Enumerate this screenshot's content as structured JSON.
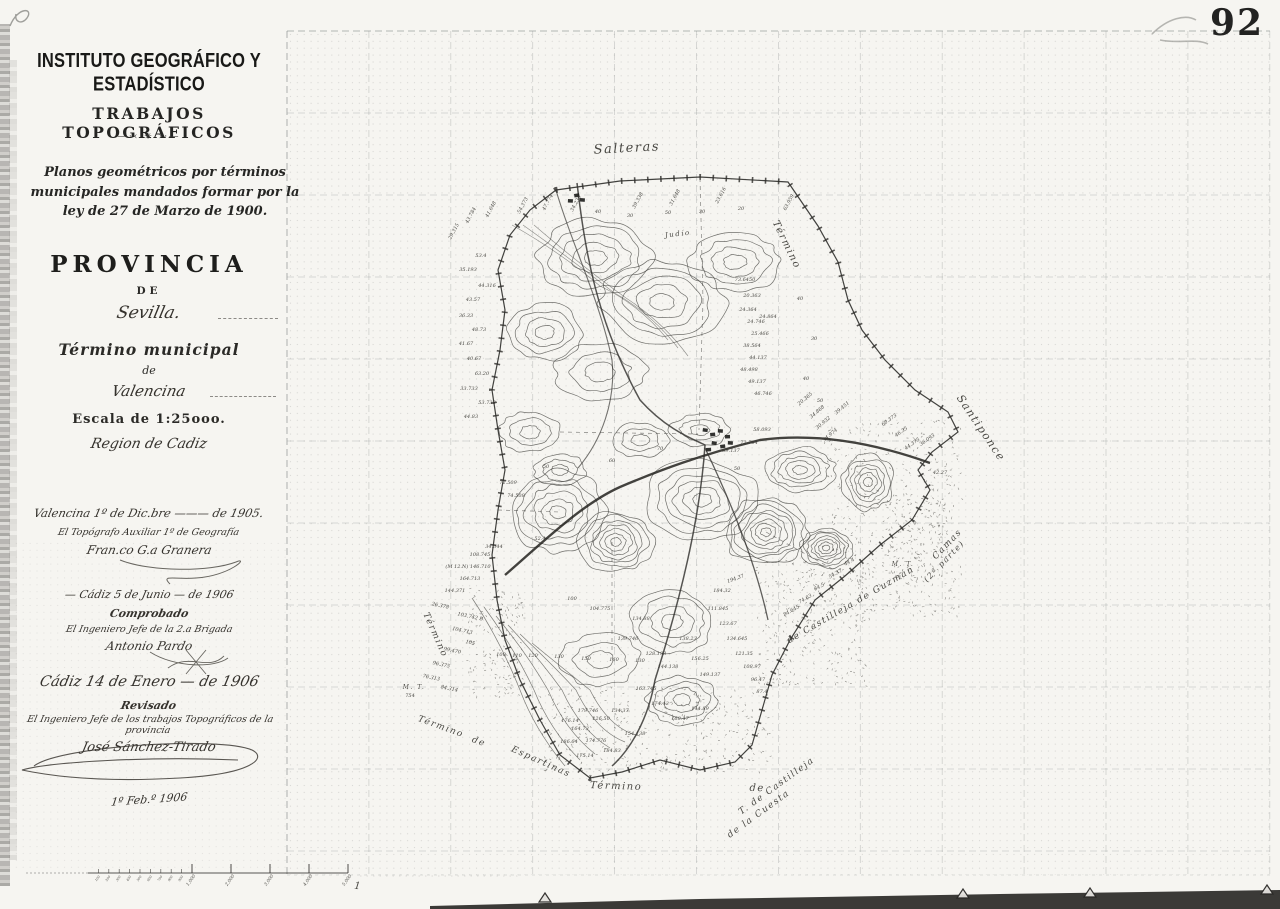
{
  "page": {
    "corner_number": "92",
    "date_note": "1º Feb.º 1906"
  },
  "title_block": {
    "institution": "INSTITUTO GEOGRÁFICO Y ESTADÍSTICO",
    "department": "TRABAJOS TOPOGRÁFICOS",
    "ornament": "―·‹  ✳  ›·―",
    "law_note": "Planos geométricos por términos municipales mandados formar por la ley de 27 de Marzo de 1900.",
    "province_label": "PROVINCIA",
    "de1": "DE",
    "province": "Sevilla.",
    "municipality_label": "Término municipal",
    "de2": "de",
    "municipality": "Valencina",
    "scale": "Escala de 1:25ooo.",
    "region": "Region de Cadiz"
  },
  "certifications": [
    {
      "place_date": "Valencina 1º de Dic.bre ——— de 1905.",
      "role": "El Topógrafo Auxiliar 1º de Geografía",
      "signature": "Fran.co G.a Granera"
    },
    {
      "place_date": "— Cádiz 5 de Junio — de 1906",
      "status": "Comprobado",
      "role": "El Ingeniero Jefe de la 2.a Brigada",
      "signature": "Antonio Pardo"
    },
    {
      "place_date": "Cádiz  14 de Enero — de 1906",
      "status": "Revisado",
      "role": "El Ingeniero Jefe de los trabajos Topográficos de la provincia",
      "signature": "José Sánchez-Tirado"
    }
  ],
  "map": {
    "place_labels": [
      {
        "t": "Salteras",
        "x": 627,
        "y": 152,
        "r": -3,
        "s": 13
      },
      {
        "t": "Término",
        "x": 784,
        "y": 246,
        "r": 64,
        "s": 10
      },
      {
        "t": "Santiponce",
        "x": 978,
        "y": 430,
        "r": 56,
        "s": 11
      },
      {
        "t": "Camas",
        "x": 949,
        "y": 546,
        "r": -46,
        "s": 9
      },
      {
        "t": "(2ª parte)",
        "x": 946,
        "y": 563,
        "r": -46,
        "s": 8
      },
      {
        "t": "de Castilleja de Guzmán",
        "x": 852,
        "y": 607,
        "r": -30,
        "s": 9
      },
      {
        "t": "T. de Castilleja",
        "x": 778,
        "y": 788,
        "r": -36,
        "s": 9
      },
      {
        "t": "de la Cuesta",
        "x": 760,
        "y": 816,
        "r": -36,
        "s": 9
      },
      {
        "t": "Término",
        "x": 433,
        "y": 636,
        "r": 66,
        "s": 9
      },
      {
        "t": "Término",
        "x": 440,
        "y": 729,
        "r": 20,
        "s": 9
      },
      {
        "t": "de",
        "x": 478,
        "y": 744,
        "r": 20,
        "s": 9
      },
      {
        "t": "Espartinas",
        "x": 540,
        "y": 764,
        "r": 24,
        "s": 9
      },
      {
        "t": "Término",
        "x": 616,
        "y": 789,
        "r": 2,
        "s": 10
      },
      {
        "t": "de",
        "x": 757,
        "y": 791,
        "r": 2,
        "s": 10
      },
      {
        "t": "Judío",
        "x": 678,
        "y": 236,
        "r": -6,
        "s": 7
      },
      {
        "t": "M. T.",
        "x": 903,
        "y": 566,
        "r": 0,
        "s": 6
      },
      {
        "t": "M. T.",
        "x": 414,
        "y": 689,
        "r": 0,
        "s": 6
      }
    ],
    "spot_heights": [
      {
        "t": "43.784",
        "x": 472,
        "y": 216,
        "r": -62
      },
      {
        "t": "41.648",
        "x": 492,
        "y": 210,
        "r": -62
      },
      {
        "t": "54.373",
        "x": 524,
        "y": 206,
        "r": -62
      },
      {
        "t": "47.774",
        "x": 549,
        "y": 203,
        "r": -62
      },
      {
        "t": "34.236",
        "x": 577,
        "y": 204,
        "r": -62
      },
      {
        "t": "39.338",
        "x": 639,
        "y": 201,
        "r": -62
      },
      {
        "t": "31.648",
        "x": 676,
        "y": 198,
        "r": -62
      },
      {
        "t": "23.616",
        "x": 722,
        "y": 196,
        "r": -62
      },
      {
        "t": "63.959",
        "x": 790,
        "y": 203,
        "r": -62
      },
      {
        "t": "29.315",
        "x": 455,
        "y": 232,
        "r": -62
      },
      {
        "t": "40",
        "x": 598,
        "y": 213,
        "r": 0
      },
      {
        "t": "30",
        "x": 630,
        "y": 217,
        "r": 0
      },
      {
        "t": "50",
        "x": 668,
        "y": 214,
        "r": 0
      },
      {
        "t": "30",
        "x": 702,
        "y": 213,
        "r": 0
      },
      {
        "t": "20",
        "x": 741,
        "y": 210,
        "r": 0
      },
      {
        "t": "53.4",
        "x": 481,
        "y": 257,
        "r": 0
      },
      {
        "t": "35.193",
        "x": 468,
        "y": 271,
        "r": 0
      },
      {
        "t": "44.316",
        "x": 487,
        "y": 287,
        "r": 0
      },
      {
        "t": "43.57",
        "x": 473,
        "y": 301,
        "r": 0
      },
      {
        "t": "36.33",
        "x": 466,
        "y": 317,
        "r": 0
      },
      {
        "t": "48.73",
        "x": 479,
        "y": 331,
        "r": 0
      },
      {
        "t": "41.67",
        "x": 466,
        "y": 345,
        "r": 0
      },
      {
        "t": "40.67",
        "x": 474,
        "y": 360,
        "r": 0
      },
      {
        "t": "63.20",
        "x": 482,
        "y": 375,
        "r": 0
      },
      {
        "t": "33.733",
        "x": 469,
        "y": 390,
        "r": 0
      },
      {
        "t": "53.733",
        "x": 487,
        "y": 404,
        "r": 0
      },
      {
        "t": "44.83",
        "x": 471,
        "y": 418,
        "r": 0
      },
      {
        "t": "72.509",
        "x": 508,
        "y": 484,
        "r": 0
      },
      {
        "t": "74.508",
        "x": 516,
        "y": 497,
        "r": 0
      },
      {
        "t": "52.4",
        "x": 540,
        "y": 540,
        "r": 0
      },
      {
        "t": "34.344",
        "x": 494,
        "y": 548,
        "r": 0
      },
      {
        "t": "108.745",
        "x": 480,
        "y": 556,
        "r": 0
      },
      {
        "t": "(M 12.N) 146.710",
        "x": 468,
        "y": 568,
        "r": 0
      },
      {
        "t": "164.713",
        "x": 470,
        "y": 580,
        "r": 0
      },
      {
        "t": "144.371",
        "x": 455,
        "y": 592,
        "r": 0
      },
      {
        "t": "73.6450",
        "x": 745,
        "y": 281,
        "r": 0
      },
      {
        "t": "20.363",
        "x": 752,
        "y": 297,
        "r": 0
      },
      {
        "t": "24.364",
        "x": 748,
        "y": 311,
        "r": 0
      },
      {
        "t": "24.746",
        "x": 756,
        "y": 323,
        "r": 0
      },
      {
        "t": "24.864",
        "x": 768,
        "y": 318,
        "r": 0
      },
      {
        "t": "25.466",
        "x": 760,
        "y": 335,
        "r": 0
      },
      {
        "t": "38.564",
        "x": 752,
        "y": 347,
        "r": 0
      },
      {
        "t": "44.137",
        "x": 758,
        "y": 359,
        "r": 0
      },
      {
        "t": "48.498",
        "x": 749,
        "y": 371,
        "r": 0
      },
      {
        "t": "49.137",
        "x": 757,
        "y": 383,
        "r": 0
      },
      {
        "t": "46.746",
        "x": 763,
        "y": 395,
        "r": 0
      },
      {
        "t": "40",
        "x": 800,
        "y": 300,
        "r": 0
      },
      {
        "t": "30",
        "x": 814,
        "y": 340,
        "r": 0
      },
      {
        "t": "40",
        "x": 806,
        "y": 380,
        "r": 0
      },
      {
        "t": "50",
        "x": 820,
        "y": 402,
        "r": 0
      },
      {
        "t": "20.365",
        "x": 806,
        "y": 400,
        "r": -40
      },
      {
        "t": "34.868",
        "x": 818,
        "y": 413,
        "r": -40
      },
      {
        "t": "30.932",
        "x": 824,
        "y": 424,
        "r": -40
      },
      {
        "t": "34.974",
        "x": 831,
        "y": 436,
        "r": -40
      },
      {
        "t": "39.451",
        "x": 843,
        "y": 409,
        "r": -40
      },
      {
        "t": "60.373",
        "x": 890,
        "y": 421,
        "r": -35
      },
      {
        "t": "46.35",
        "x": 902,
        "y": 433,
        "r": -35
      },
      {
        "t": "44.375",
        "x": 913,
        "y": 445,
        "r": -35
      },
      {
        "t": "36.093",
        "x": 928,
        "y": 441,
        "r": -35
      },
      {
        "t": "42.27",
        "x": 940,
        "y": 474,
        "r": 0
      },
      {
        "t": "69.137",
        "x": 731,
        "y": 452,
        "r": 0
      },
      {
        "t": "72.764",
        "x": 749,
        "y": 444,
        "r": 0
      },
      {
        "t": "58.093",
        "x": 762,
        "y": 431,
        "r": 0
      },
      {
        "t": "70",
        "x": 660,
        "y": 450,
        "r": 0
      },
      {
        "t": "60",
        "x": 612,
        "y": 462,
        "r": 0
      },
      {
        "t": "50",
        "x": 546,
        "y": 468,
        "r": 0
      },
      {
        "t": "50",
        "x": 737,
        "y": 470,
        "r": 0
      },
      {
        "t": "100",
        "x": 572,
        "y": 600,
        "r": 0
      },
      {
        "t": "100",
        "x": 501,
        "y": 656,
        "r": 0
      },
      {
        "t": "110",
        "x": 517,
        "y": 657,
        "r": 0
      },
      {
        "t": "120",
        "x": 533,
        "y": 657,
        "r": 0
      },
      {
        "t": "130",
        "x": 559,
        "y": 658,
        "r": 0
      },
      {
        "t": "150",
        "x": 586,
        "y": 660,
        "r": 0
      },
      {
        "t": "160",
        "x": 614,
        "y": 661,
        "r": 0
      },
      {
        "t": "130",
        "x": 640,
        "y": 662,
        "r": 0
      },
      {
        "t": "103.742 B",
        "x": 470,
        "y": 618,
        "r": 12
      },
      {
        "t": "104.713",
        "x": 462,
        "y": 632,
        "r": 12
      },
      {
        "t": "105",
        "x": 470,
        "y": 644,
        "r": 12
      },
      {
        "t": "99.470",
        "x": 452,
        "y": 652,
        "r": 12
      },
      {
        "t": "96.375",
        "x": 441,
        "y": 666,
        "r": 12
      },
      {
        "t": "76.313",
        "x": 431,
        "y": 679,
        "r": 12
      },
      {
        "t": "84.314",
        "x": 449,
        "y": 690,
        "r": 12
      },
      {
        "t": "26.378",
        "x": 440,
        "y": 607,
        "r": 12
      },
      {
        "t": "754",
        "x": 410,
        "y": 697,
        "r": 0
      },
      {
        "t": "104.775",
        "x": 600,
        "y": 610,
        "r": 0
      },
      {
        "t": "134.88",
        "x": 641,
        "y": 620,
        "r": 0
      },
      {
        "t": "139.746",
        "x": 628,
        "y": 640,
        "r": 0
      },
      {
        "t": "128.193",
        "x": 656,
        "y": 655,
        "r": 0
      },
      {
        "t": "144.138",
        "x": 668,
        "y": 668,
        "r": 0
      },
      {
        "t": "138.23",
        "x": 688,
        "y": 640,
        "r": 0
      },
      {
        "t": "156.25",
        "x": 700,
        "y": 660,
        "r": 0
      },
      {
        "t": "149.137",
        "x": 710,
        "y": 676,
        "r": 0
      },
      {
        "t": "163.745",
        "x": 646,
        "y": 690,
        "r": 0
      },
      {
        "t": "174.43",
        "x": 660,
        "y": 705,
        "r": 0
      },
      {
        "t": "134.37",
        "x": 620,
        "y": 712,
        "r": 0
      },
      {
        "t": "126.50",
        "x": 601,
        "y": 720,
        "r": 0
      },
      {
        "t": "164.73",
        "x": 580,
        "y": 730,
        "r": 0
      },
      {
        "t": "174.776",
        "x": 596,
        "y": 742,
        "r": 0
      },
      {
        "t": "184.83",
        "x": 612,
        "y": 752,
        "r": 0
      },
      {
        "t": "175.14",
        "x": 585,
        "y": 757,
        "r": 0
      },
      {
        "t": "186.64",
        "x": 569,
        "y": 743,
        "r": 0
      },
      {
        "t": "154.138",
        "x": 635,
        "y": 735,
        "r": 0
      },
      {
        "t": "168.47",
        "x": 680,
        "y": 720,
        "r": 0
      },
      {
        "t": "144.89",
        "x": 700,
        "y": 710,
        "r": 0
      },
      {
        "t": "179.746",
        "x": 588,
        "y": 712,
        "r": 0
      },
      {
        "t": "176.14",
        "x": 570,
        "y": 722,
        "r": 0
      },
      {
        "t": "111.845",
        "x": 718,
        "y": 610,
        "r": 0
      },
      {
        "t": "123.67",
        "x": 728,
        "y": 625,
        "r": 0
      },
      {
        "t": "134.645",
        "x": 737,
        "y": 640,
        "r": 0
      },
      {
        "t": "121.35",
        "x": 744,
        "y": 655,
        "r": 0
      },
      {
        "t": "108.97",
        "x": 752,
        "y": 668,
        "r": 0
      },
      {
        "t": "96.47",
        "x": 758,
        "y": 681,
        "r": 0
      },
      {
        "t": "87.4",
        "x": 762,
        "y": 693,
        "r": 0
      },
      {
        "t": "184.32",
        "x": 722,
        "y": 592,
        "r": 0
      },
      {
        "t": "194.37",
        "x": 736,
        "y": 580,
        "r": -20
      },
      {
        "t": "84.645",
        "x": 792,
        "y": 612,
        "r": -30
      },
      {
        "t": "74.63",
        "x": 806,
        "y": 600,
        "r": -30
      },
      {
        "t": "64.5",
        "x": 820,
        "y": 588,
        "r": -30
      },
      {
        "t": "54.37",
        "x": 836,
        "y": 575,
        "r": -30
      },
      {
        "t": "44.4",
        "x": 850,
        "y": 563,
        "r": -30
      }
    ],
    "scale_bar": {
      "minor_labels": [
        "100",
        "200",
        "300",
        "400",
        "500",
        "600",
        "700",
        "800",
        "900"
      ],
      "major_labels": [
        "1.000",
        "2.000",
        "3.000",
        "4.000",
        "5.000"
      ]
    }
  }
}
